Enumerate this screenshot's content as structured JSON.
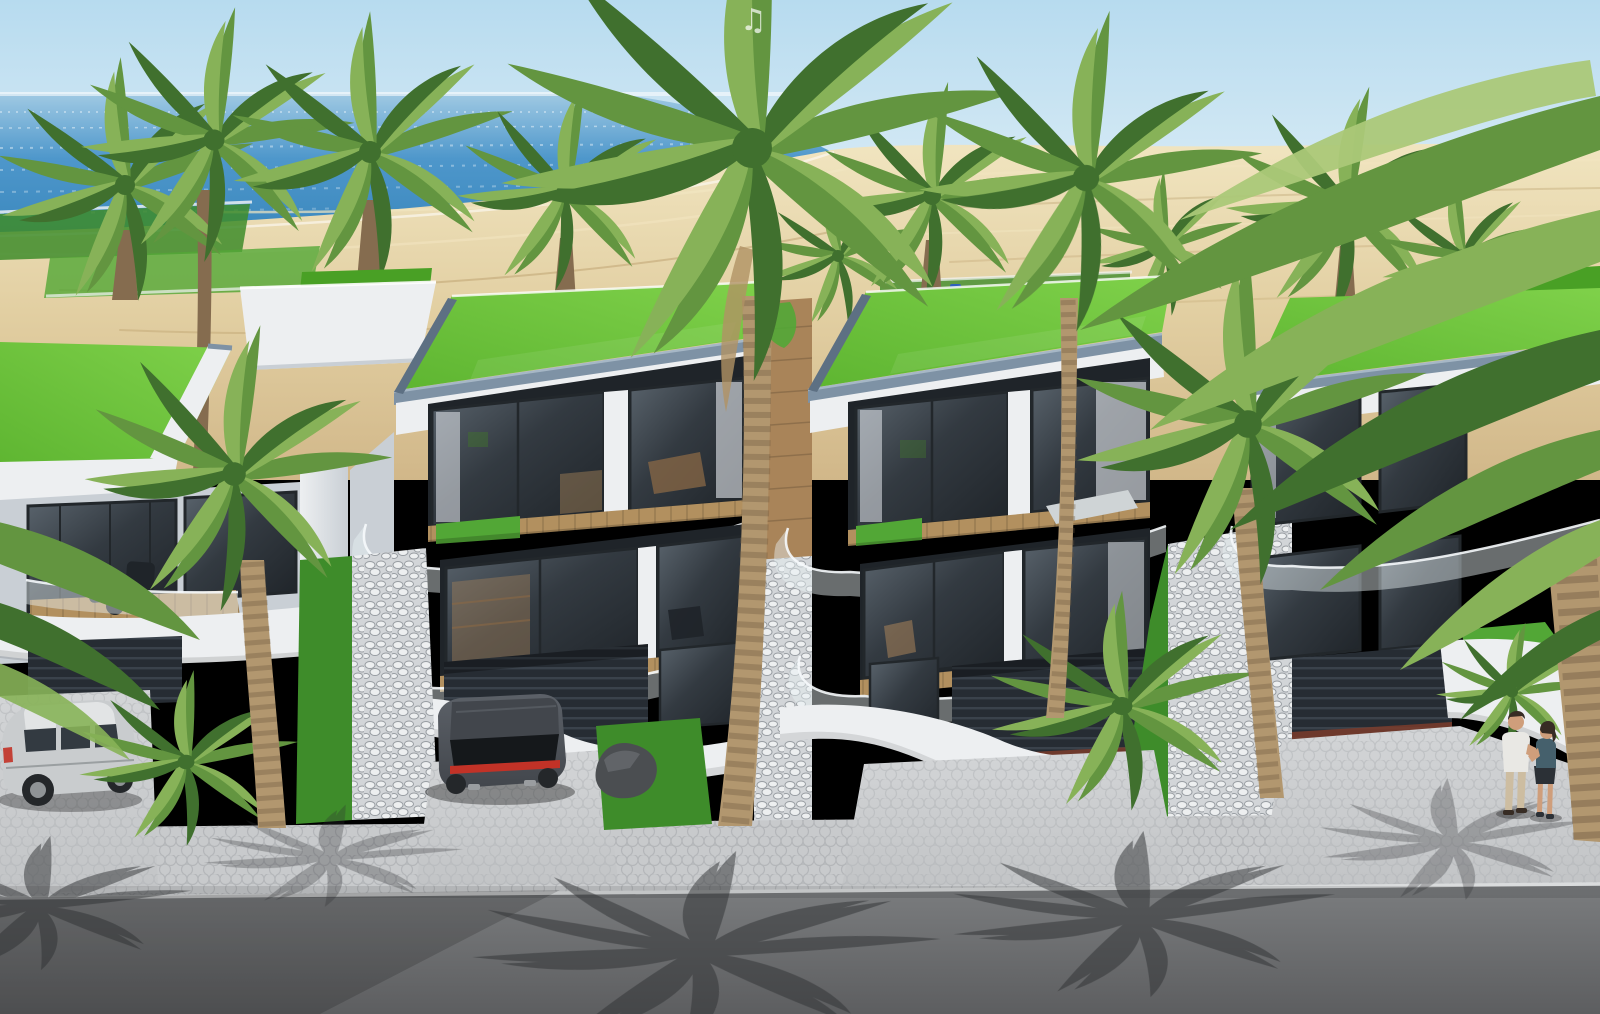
{
  "meta": {
    "description": "Photorealistic 3D architectural rendering: a row of modern three-storey beachfront villas with flat green grass roofs, curved white balconies with frameless glass railings, floor-to-ceiling glazing and street-level garages; sandy beach and calm blue sea behind; palm trees throughout; asphalt road with palm-frond shadows in the foreground",
    "view": "elevated three-quarter aerial view"
  },
  "watermark": {
    "glyph": "♫"
  },
  "palette": {
    "skyTop": "#b7dbef",
    "skyHz": "#eaf4f9",
    "seaFar": "#9fc9e3",
    "sea": "#4e97cb",
    "seaDeep": "#3a87bd",
    "sandHi": "#f1e5c0",
    "sand": "#e2cfa2",
    "sandLo": "#d1b789",
    "sandTrack": "#bfa472",
    "grassHi": "#7fd14a",
    "grass": "#5eb531",
    "grassLo": "#49a025",
    "lawn": "#3e8c2a",
    "lawnHi": "#52a736",
    "wall": "#edeff1",
    "wallSh": "#c9cfd5",
    "wallDk": "#9aa3ac",
    "trim": "#7e92a5",
    "trimDk": "#5d7083",
    "trimHi": "#a6b7c6",
    "glassHi": "#5a646d",
    "glass": "#333a41",
    "glassLo": "#1f2429",
    "frame": "#22272b",
    "curtain": "#e6eaee",
    "wood": "#a98459",
    "woodDk": "#8a6845",
    "deck": "#b2905f",
    "garage": "#262c33",
    "garageLn": "#3a424b",
    "brick": "#7b3c2c",
    "pebble": "#d2d5d8",
    "stone": "#edeff0",
    "stoneGap": "#989da2",
    "pave": "#c8cacc",
    "paveLn": "#b0b3b6",
    "curb": "#dadcdd",
    "asph": "#7b7d7f",
    "asphLo": "#5d5e60",
    "shadow": "#2f3133",
    "trunk": "#b2976f",
    "trunkSh": "#856c4f",
    "ring": "#6c5840",
    "frondDk": "#40702e",
    "frondMd": "#639540",
    "frondLt": "#87b258",
    "frondPale": "#abc878",
    "silver": "#c9ccce",
    "silverHi": "#e2e4e5",
    "silverSh": "#8f9396",
    "carDk": "#42464c",
    "carHi": "#5c6168",
    "tail": "#c23227",
    "tire": "#24272a",
    "glassCar": "#15181b",
    "skin": "#cf9e7b",
    "hair": "#372c24",
    "shirt": "#e9e8e4",
    "pants": "#cdbda1",
    "wTop": "#45606c",
    "wSkirt": "#2b3036",
    "boulder": "#4b4e51",
    "boulderHi": "#666a6e",
    "blueObj": "#2a5bc8"
  },
  "scene": {
    "background": {
      "sky": "clear pale blue sky",
      "ocean": "calm blue sea with sparkle",
      "beach": "wide sandy beach with foot tracks"
    },
    "buildings": [
      {
        "name": "villa-far-left",
        "features": [
          "green roof",
          "balcony with two chairs",
          "garage"
        ]
      },
      {
        "name": "villa-center-left",
        "features": [
          "green grass roof",
          "two glazed floors",
          "curved glass balconies",
          "garage",
          "driveway"
        ]
      },
      {
        "name": "villa-center-right",
        "features": [
          "green grass roof",
          "two glazed floors",
          "lounge furniture",
          "garage",
          "wide driveway"
        ]
      },
      {
        "name": "villa-right-partial",
        "features": [
          "green roof",
          "glazing behind palms",
          "garage",
          "curved white wall"
        ]
      }
    ],
    "vehicles": [
      {
        "name": "silver-suv",
        "position": "left driveway"
      },
      {
        "name": "dark-grey-sports-car",
        "position": "center-left driveway"
      }
    ],
    "people": [
      {
        "name": "couple",
        "count": 2,
        "position": "right driveway"
      }
    ],
    "vegetation": {
      "tall_palms": 6,
      "beach_palms": 9,
      "shrub_palms": 3,
      "green_roofs": 4,
      "lawn_strips": true
    },
    "ground": [
      "white pebble landscaping",
      "hex paver sidewalk",
      "asphalt road with palm shadows"
    ]
  }
}
